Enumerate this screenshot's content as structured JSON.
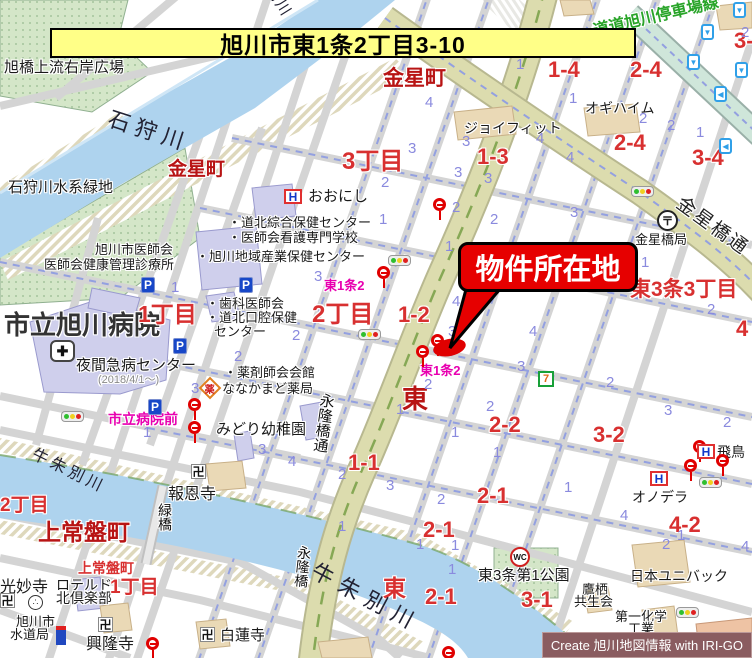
{
  "banner": {
    "text": "旭川市東1条2丁目3-10"
  },
  "callout": {
    "text": "物件所在地"
  },
  "credit": {
    "text": "Create 旭川地図情報 with IRI-GO"
  },
  "palette": {
    "banner_bg": "#ffff87",
    "red_dark": "#b81414",
    "red_block": "#d83030",
    "blue_lot": "#8a8ade",
    "magenta_stop": "#e800b0",
    "green_road_name": "#28a428",
    "place_black": "#1a1a1a",
    "river_label": "#222233",
    "gray_note": "#888888",
    "river_fill": "#aed3ee",
    "road_major_fill": "#dcdcae",
    "park_fill": "#d4e6c8",
    "building_public": "#cfcfec",
    "building_commercial": "#ead9b6",
    "highlight_red": "#e60000"
  },
  "icon_glyphs": {
    "parking": "P",
    "hotel": "H",
    "post": "〒",
    "temple": "卍",
    "wc": "WC",
    "seven": "7",
    "pharmacy": "薬",
    "arrow_down": "▼",
    "arrow_left": "◀",
    "monument": "∴",
    "hospital_cross": "✚"
  },
  "map": {
    "labels": [
      {
        "k": "place",
        "t": "旭橋上流右岸広場",
        "x": 4,
        "y": 60,
        "fs": 15
      },
      {
        "k": "place",
        "t": "石狩川水系緑地",
        "x": 8,
        "y": 180,
        "fs": 15
      },
      {
        "k": "place",
        "t": "おおにし",
        "x": 308,
        "y": 189,
        "fs": 15
      },
      {
        "k": "place",
        "t": "・道北綜合保健センター",
        "x": 228,
        "y": 216,
        "fs": 13
      },
      {
        "k": "place",
        "t": "・医師会看護専門学校",
        "x": 228,
        "y": 231,
        "fs": 13
      },
      {
        "k": "place",
        "t": "・旭川地域産業保健センター",
        "x": 196,
        "y": 250,
        "fs": 13
      },
      {
        "k": "place",
        "t": "旭川市医師会",
        "x": 95,
        "y": 243,
        "fs": 13
      },
      {
        "k": "place",
        "t": "医師会健康管理診療所",
        "x": 44,
        "y": 258,
        "fs": 13
      },
      {
        "k": "place",
        "t": "市立旭川病院",
        "x": 4,
        "y": 312,
        "fs": 26,
        "b": 1,
        "c": "#333333"
      },
      {
        "k": "place",
        "t": "夜間急病センター",
        "x": 76,
        "y": 358,
        "fs": 15
      },
      {
        "k": "place",
        "t": "(2018/4/1～)",
        "x": 98,
        "y": 375,
        "fs": 11,
        "c": "$gray_note"
      },
      {
        "k": "place",
        "t": "・歯科医師会",
        "x": 206,
        "y": 297,
        "fs": 13
      },
      {
        "k": "place",
        "t": "・道北口腔保健",
        "x": 206,
        "y": 311,
        "fs": 13
      },
      {
        "k": "place",
        "t": "センター",
        "x": 214,
        "y": 325,
        "fs": 13
      },
      {
        "k": "place",
        "t": "・薬剤師会会館",
        "x": 224,
        "y": 366,
        "fs": 13
      },
      {
        "k": "place",
        "t": "ななかまど薬局",
        "x": 222,
        "y": 382,
        "fs": 13
      },
      {
        "k": "place",
        "t": "みどり幼稚園",
        "x": 216,
        "y": 422,
        "fs": 15
      },
      {
        "k": "place",
        "t": "報恩寺",
        "x": 168,
        "y": 487,
        "fs": 16
      },
      {
        "k": "place",
        "t": "ジョイフィット",
        "x": 464,
        "y": 121,
        "fs": 14
      },
      {
        "k": "place",
        "t": "オギハイム",
        "x": 585,
        "y": 101,
        "fs": 14
      },
      {
        "k": "place",
        "t": "金星橋局",
        "x": 635,
        "y": 233,
        "fs": 13
      },
      {
        "k": "place",
        "t": "オノデラ",
        "x": 632,
        "y": 490,
        "fs": 14
      },
      {
        "k": "place",
        "t": "飛鳥",
        "x": 717,
        "y": 445,
        "fs": 14
      },
      {
        "k": "place",
        "t": "東3条第1公園",
        "x": 478,
        "y": 568,
        "fs": 15
      },
      {
        "k": "place",
        "t": "日本ユニバック",
        "x": 630,
        "y": 569,
        "fs": 14
      },
      {
        "k": "place",
        "t": "鷹栖",
        "x": 582,
        "y": 583,
        "fs": 13
      },
      {
        "k": "place",
        "t": "共生会",
        "x": 574,
        "y": 595,
        "fs": 13
      },
      {
        "k": "place",
        "t": "第一化学",
        "x": 615,
        "y": 610,
        "fs": 13
      },
      {
        "k": "place",
        "t": "工業",
        "x": 628,
        "y": 622,
        "fs": 13
      },
      {
        "k": "place",
        "t": "白蓮寺",
        "x": 220,
        "y": 628,
        "fs": 15
      },
      {
        "k": "place",
        "t": "興隆寺",
        "x": 86,
        "y": 637,
        "fs": 16
      },
      {
        "k": "place",
        "t": "光妙寺",
        "x": 0,
        "y": 580,
        "fs": 16
      },
      {
        "k": "place",
        "t": "ロテルド",
        "x": 56,
        "y": 578,
        "fs": 14
      },
      {
        "k": "place",
        "t": "北倶楽部",
        "x": 56,
        "y": 591,
        "fs": 14
      },
      {
        "k": "place",
        "t": "旭川市",
        "x": 16,
        "y": 615,
        "fs": 13
      },
      {
        "k": "place",
        "t": "水道局",
        "x": 10,
        "y": 628,
        "fs": 13
      },
      {
        "k": "district",
        "t": "金星町",
        "x": 383,
        "y": 68,
        "fs": 21,
        "b": 1,
        "c": "$red_dark"
      },
      {
        "k": "district",
        "t": "金星町",
        "x": 168,
        "y": 160,
        "fs": 19,
        "b": 1,
        "c": "$red_dark"
      },
      {
        "k": "district",
        "t": "3丁目",
        "x": 342,
        "y": 150,
        "fs": 24,
        "b": 1,
        "c": "$red_block"
      },
      {
        "k": "district",
        "t": "1丁目",
        "x": 138,
        "y": 303,
        "fs": 23,
        "b": 1,
        "c": "$red_block"
      },
      {
        "k": "district",
        "t": "2丁目",
        "x": 312,
        "y": 303,
        "fs": 24,
        "b": 1,
        "c": "$red_block"
      },
      {
        "k": "district",
        "t": "東3条3丁目",
        "x": 630,
        "y": 279,
        "fs": 21,
        "b": 1,
        "c": "$red_block"
      },
      {
        "k": "district",
        "t": "上常盤町",
        "x": 38,
        "y": 521,
        "fs": 23,
        "b": 1,
        "c": "$red_dark"
      },
      {
        "k": "district",
        "t": "2丁目",
        "x": 0,
        "y": 496,
        "fs": 19,
        "b": 1,
        "c": "$red_block"
      },
      {
        "k": "district",
        "t": "上常盤町",
        "x": 78,
        "y": 561,
        "fs": 14,
        "b": 1,
        "c": "$red_block"
      },
      {
        "k": "district",
        "t": "1丁目",
        "x": 110,
        "y": 578,
        "fs": 19,
        "b": 1,
        "c": "$red_block"
      },
      {
        "k": "district",
        "t": "東",
        "x": 402,
        "y": 386,
        "fs": 26,
        "b": 1,
        "c": "$red_dark"
      },
      {
        "k": "district",
        "t": "東",
        "x": 383,
        "y": 577,
        "fs": 23,
        "b": 1,
        "c": "$red_block"
      },
      {
        "k": "block",
        "t": "1-4",
        "x": 548,
        "y": 59,
        "fs": 22,
        "b": 1,
        "c": "$red_block"
      },
      {
        "k": "block",
        "t": "2-4",
        "x": 630,
        "y": 59,
        "fs": 22,
        "b": 1,
        "c": "$red_block"
      },
      {
        "k": "block",
        "t": "3-",
        "x": 734,
        "y": 30,
        "fs": 22,
        "b": 1,
        "c": "$red_block"
      },
      {
        "k": "block",
        "t": "1-3",
        "x": 477,
        "y": 146,
        "fs": 22,
        "b": 1,
        "c": "$red_block"
      },
      {
        "k": "block",
        "t": "2-4",
        "x": 614,
        "y": 132,
        "fs": 22,
        "b": 1,
        "c": "$red_block"
      },
      {
        "k": "block",
        "t": "3-4",
        "x": 692,
        "y": 147,
        "fs": 22,
        "b": 1,
        "c": "$red_block"
      },
      {
        "k": "block",
        "t": "1-2",
        "x": 398,
        "y": 304,
        "fs": 22,
        "b": 1,
        "c": "$red_block"
      },
      {
        "k": "block",
        "t": "1-1",
        "x": 348,
        "y": 452,
        "fs": 22,
        "b": 1,
        "c": "$red_block"
      },
      {
        "k": "block",
        "t": "2-2",
        "x": 489,
        "y": 414,
        "fs": 22,
        "b": 1,
        "c": "$red_block"
      },
      {
        "k": "block",
        "t": "3-2",
        "x": 593,
        "y": 424,
        "fs": 22,
        "b": 1,
        "c": "$red_block"
      },
      {
        "k": "block",
        "t": "2-1",
        "x": 423,
        "y": 519,
        "fs": 22,
        "b": 1,
        "c": "$red_block"
      },
      {
        "k": "block",
        "t": "2-1",
        "x": 477,
        "y": 485,
        "fs": 22,
        "b": 1,
        "c": "$red_block"
      },
      {
        "k": "block",
        "t": "2-1",
        "x": 425,
        "y": 586,
        "fs": 22,
        "b": 1,
        "c": "$red_block"
      },
      {
        "k": "block",
        "t": "3-1",
        "x": 521,
        "y": 589,
        "fs": 22,
        "b": 1,
        "c": "$red_block"
      },
      {
        "k": "block",
        "t": "4-2",
        "x": 669,
        "y": 514,
        "fs": 22,
        "b": 1,
        "c": "$red_block"
      },
      {
        "k": "block",
        "t": "4",
        "x": 736,
        "y": 318,
        "fs": 22,
        "b": 1,
        "c": "$red_block"
      },
      {
        "k": "river",
        "t": "石狩川",
        "x": 112,
        "y": 108,
        "fs": 22,
        "r": 18,
        "ls": 6,
        "c": "$river_label"
      },
      {
        "k": "river",
        "t": "牛朱別川",
        "x": 258,
        "y": -46,
        "fs": 15,
        "r": 58,
        "ls": 2,
        "c": "$river_label"
      },
      {
        "k": "river",
        "t": "牛朱別川",
        "x": 36,
        "y": 447,
        "fs": 16,
        "r": 26,
        "ls": 4,
        "c": "$river_label"
      },
      {
        "k": "river",
        "t": "牛朱別川",
        "x": 318,
        "y": 560,
        "fs": 22,
        "r": 28,
        "ls": 8,
        "c": "$river_label"
      },
      {
        "k": "road",
        "t": "道道旭川停車場線",
        "x": 592,
        "y": 24,
        "fs": 16,
        "r": -13,
        "b": 1,
        "c": "$green_road_name"
      },
      {
        "k": "road",
        "t": "金星橋通",
        "x": 684,
        "y": 194,
        "fs": 19,
        "r": 36,
        "ls": 2,
        "c": "#222222"
      },
      {
        "k": "road",
        "t": "永隆橋通",
        "x": 320,
        "y": 392,
        "fs": 15,
        "v": 1,
        "r": 8,
        "c": "#111111"
      },
      {
        "k": "road",
        "t": "永隆橋",
        "x": 298,
        "y": 545,
        "fs": 14,
        "v": 1,
        "r": 6,
        "c": "#111111"
      },
      {
        "k": "road",
        "t": "緑橋",
        "x": 158,
        "y": 503,
        "fs": 14,
        "v": 1,
        "c": "#111111"
      },
      {
        "k": "stop",
        "t": "東1条2",
        "x": 324,
        "y": 279,
        "fs": 13,
        "b": 1,
        "c": "$magenta_stop"
      },
      {
        "k": "stop",
        "t": "東1条2",
        "x": 420,
        "y": 364,
        "fs": 13,
        "b": 1,
        "c": "$magenta_stop"
      },
      {
        "k": "stop",
        "t": "市立病院前",
        "x": 108,
        "y": 412,
        "fs": 14,
        "b": 1,
        "c": "$magenta_stop"
      },
      {
        "k": "lot",
        "t": "4",
        "x": 425,
        "y": 95
      },
      {
        "k": "lot",
        "t": "1",
        "x": 516,
        "y": 57
      },
      {
        "k": "lot",
        "t": "1",
        "x": 569,
        "y": 91
      },
      {
        "k": "lot",
        "t": "2",
        "x": 639,
        "y": 111
      },
      {
        "k": "lot",
        "t": "1",
        "x": 696,
        "y": 125
      },
      {
        "k": "lot",
        "t": "4",
        "x": 566,
        "y": 150
      },
      {
        "k": "lot",
        "t": "4",
        "x": 536,
        "y": 131
      },
      {
        "k": "lot",
        "t": "3",
        "x": 570,
        "y": 205
      },
      {
        "k": "lot",
        "t": "3",
        "x": 462,
        "y": 134
      },
      {
        "k": "lot",
        "t": "3",
        "x": 454,
        "y": 165
      },
      {
        "k": "lot",
        "t": "3",
        "x": 484,
        "y": 171
      },
      {
        "k": "lot",
        "t": "3",
        "x": 408,
        "y": 141
      },
      {
        "k": "lot",
        "t": "2",
        "x": 381,
        "y": 175
      },
      {
        "k": "lot",
        "t": "2",
        "x": 452,
        "y": 200
      },
      {
        "k": "lot",
        "t": "2",
        "x": 490,
        "y": 212
      },
      {
        "k": "lot",
        "t": "1",
        "x": 379,
        "y": 212
      },
      {
        "k": "lot",
        "t": "1",
        "x": 445,
        "y": 239
      },
      {
        "k": "lot",
        "t": "3",
        "x": 314,
        "y": 269
      },
      {
        "k": "lot",
        "t": "2",
        "x": 292,
        "y": 328
      },
      {
        "k": "lot",
        "t": "2",
        "x": 234,
        "y": 349
      },
      {
        "k": "lot",
        "t": "1",
        "x": 171,
        "y": 280
      },
      {
        "k": "lot",
        "t": "4",
        "x": 452,
        "y": 294
      },
      {
        "k": "lot",
        "t": "3",
        "x": 448,
        "y": 324
      },
      {
        "k": "lot",
        "t": "4",
        "x": 529,
        "y": 324
      },
      {
        "k": "lot",
        "t": "3",
        "x": 517,
        "y": 359
      },
      {
        "k": "lot",
        "t": "2",
        "x": 424,
        "y": 377
      },
      {
        "k": "lot",
        "t": "1",
        "x": 396,
        "y": 402
      },
      {
        "k": "lot",
        "t": "2",
        "x": 486,
        "y": 399
      },
      {
        "k": "lot",
        "t": "2",
        "x": 606,
        "y": 375
      },
      {
        "k": "lot",
        "t": "1",
        "x": 641,
        "y": 255
      },
      {
        "k": "lot",
        "t": "2",
        "x": 707,
        "y": 302
      },
      {
        "k": "lot",
        "t": "3",
        "x": 258,
        "y": 442
      },
      {
        "k": "lot",
        "t": "4",
        "x": 288,
        "y": 454
      },
      {
        "k": "lot",
        "t": "2",
        "x": 338,
        "y": 467
      },
      {
        "k": "lot",
        "t": "3",
        "x": 386,
        "y": 478
      },
      {
        "k": "lot",
        "t": "2",
        "x": 437,
        "y": 492
      },
      {
        "k": "lot",
        "t": "1",
        "x": 338,
        "y": 519
      },
      {
        "k": "lot",
        "t": "1",
        "x": 451,
        "y": 538
      },
      {
        "k": "lot",
        "t": "1",
        "x": 451,
        "y": 425
      },
      {
        "k": "lot",
        "t": "1",
        "x": 493,
        "y": 445
      },
      {
        "k": "lot",
        "t": "3",
        "x": 664,
        "y": 403
      },
      {
        "k": "lot",
        "t": "2",
        "x": 723,
        "y": 415
      },
      {
        "k": "lot",
        "t": "1",
        "x": 564,
        "y": 480
      },
      {
        "k": "lot",
        "t": "4",
        "x": 620,
        "y": 508
      },
      {
        "k": "lot",
        "t": "1",
        "x": 677,
        "y": 528
      },
      {
        "k": "lot",
        "t": "2",
        "x": 662,
        "y": 537
      },
      {
        "k": "lot",
        "t": "1",
        "x": 143,
        "y": 425
      },
      {
        "k": "lot",
        "t": "1",
        "x": 416,
        "y": 537
      },
      {
        "k": "lot",
        "t": "1",
        "x": 448,
        "y": 562
      },
      {
        "k": "lot",
        "t": "4",
        "x": 741,
        "y": 539
      },
      {
        "k": "lot",
        "t": "3",
        "x": 191,
        "y": 381
      },
      {
        "k": "lot",
        "t": "2",
        "x": 667,
        "y": 118
      },
      {
        "k": "lot",
        "t": "2",
        "x": 741,
        "y": 25
      }
    ],
    "icons": [
      {
        "type": "busstop",
        "x": 433,
        "y": 198
      },
      {
        "type": "busstop",
        "x": 377,
        "y": 266
      },
      {
        "type": "busstop",
        "x": 431,
        "y": 334
      },
      {
        "type": "busstop",
        "x": 416,
        "y": 345
      },
      {
        "type": "busstop",
        "x": 188,
        "y": 398
      },
      {
        "type": "busstop",
        "x": 188,
        "y": 421
      },
      {
        "type": "busstop",
        "x": 146,
        "y": 637
      },
      {
        "type": "busstop",
        "x": 442,
        "y": 646
      },
      {
        "type": "busstop",
        "x": 693,
        "y": 440
      },
      {
        "type": "busstop",
        "x": 684,
        "y": 459
      },
      {
        "type": "busstop",
        "x": 716,
        "y": 454
      },
      {
        "type": "traffic",
        "x": 388,
        "y": 255
      },
      {
        "type": "traffic",
        "x": 358,
        "y": 329
      },
      {
        "type": "traffic",
        "x": 61,
        "y": 411
      },
      {
        "type": "traffic",
        "x": 631,
        "y": 186
      },
      {
        "type": "traffic",
        "x": 676,
        "y": 607
      },
      {
        "type": "traffic",
        "x": 699,
        "y": 477
      },
      {
        "type": "parking",
        "x": 141,
        "y": 277
      },
      {
        "type": "parking",
        "x": 239,
        "y": 277
      },
      {
        "type": "parking",
        "x": 173,
        "y": 338
      },
      {
        "type": "parking",
        "x": 148,
        "y": 399
      },
      {
        "type": "hotel",
        "x": 284,
        "y": 189
      },
      {
        "type": "hotel",
        "x": 650,
        "y": 471
      },
      {
        "type": "hotel",
        "x": 697,
        "y": 444
      },
      {
        "type": "post",
        "x": 657,
        "y": 210
      },
      {
        "type": "temple",
        "x": 191,
        "y": 464
      },
      {
        "type": "temple",
        "x": 98,
        "y": 617
      },
      {
        "type": "temple",
        "x": 200,
        "y": 627
      },
      {
        "type": "temple",
        "x": 0,
        "y": 593
      },
      {
        "type": "monument",
        "x": 28,
        "y": 595
      },
      {
        "type": "hospital_cross",
        "x": 50,
        "y": 340
      },
      {
        "type": "pharmacy",
        "x": 202,
        "y": 380
      },
      {
        "type": "wc",
        "x": 510,
        "y": 547
      },
      {
        "type": "seven",
        "x": 538,
        "y": 371
      },
      {
        "type": "facility",
        "x": 56,
        "y": 626
      },
      {
        "type": "arrow_down",
        "x": 701,
        "y": 24
      },
      {
        "type": "arrow_down",
        "x": 687,
        "y": 54
      },
      {
        "type": "arrow_down",
        "x": 733,
        "y": 2
      },
      {
        "type": "arrow_down",
        "x": 735,
        "y": 62
      },
      {
        "type": "arrow_left",
        "x": 714,
        "y": 86
      },
      {
        "type": "arrow_left",
        "x": 719,
        "y": 138
      },
      {
        "type": "marker",
        "x": 433,
        "y": 339
      }
    ]
  }
}
